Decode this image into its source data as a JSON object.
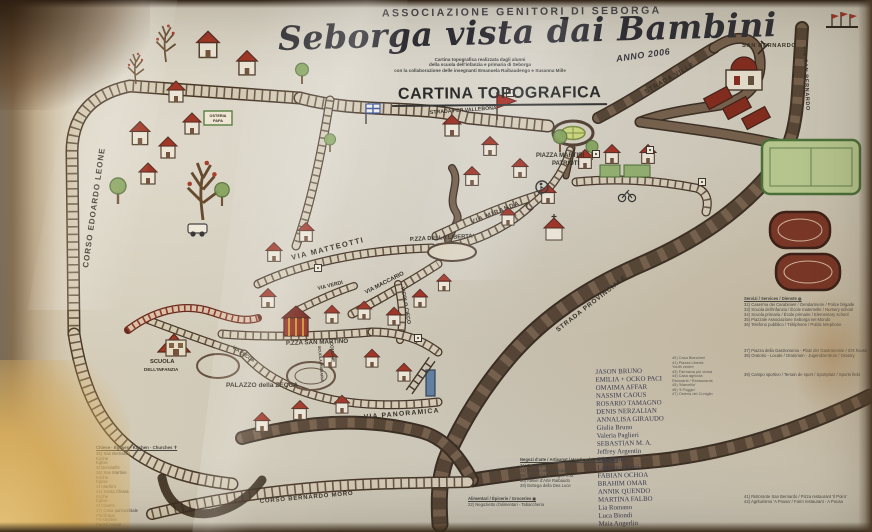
{
  "header": {
    "association": "ASSOCIAZIONE GENITORI DI SEBORGA",
    "title": "Seborga vista dai Bambini",
    "year": "ANNO 2006",
    "credits": [
      "Cartina topografica realizzata dagli alunni",
      "della scuola dell'infanzia e primaria di Seborga",
      "con la collaborazione delle insegnanti Emanuela Raibaudengo e Susanna Mille"
    ],
    "map_type": "CARTINA TOPOGRAFICA"
  },
  "streets": {
    "corso_edoardo_leone": "CORSO EDOARDO LEONE",
    "strada_per_vallebona": "STRADA PER VALLEBONA",
    "strada_ville": "STRADA VILLE",
    "via_san_bernardo": "VIA SAN BERNARDO",
    "strada_provinciale": "STRADA PROVINCIALE",
    "via_matteotti": "VIA MATTEOTTI",
    "via_verdi": "VIA VERDI",
    "via_maccario": "VIA MACCARIO",
    "vicolo_cieco": "VICOLO CIECO",
    "via_miranda": "VIA MIRANDA",
    "via_zecca": "VIA ZECCA",
    "via_panoramica": "VIA PANORAMICA",
    "corso_bernardo_moro": "CORSO BERNARDO MORO"
  },
  "places": {
    "san_bernardo": "SAN BERNARDO",
    "piazza_martiri_line1": "PIAZZA MARTIRI",
    "piazza_martiri_line2": "PATRIOTI",
    "piazza_liberta": "P.ZZA DELLA LIBERTA'",
    "piazza_san_martino": "P.ZZA SAN MARTINO",
    "palazzo_zecca": "PALAZZO della ZECCA",
    "scuola_line1": "SCUOLA",
    "scuola_line2": "DELL'INFANZIA",
    "scuola_primaria": "SCUOLA PRIMARIA",
    "comune": "COMUNE",
    "osteria_line1": "OSTERIA",
    "osteria_line2": "PAPA"
  },
  "legend_churches": {
    "title": "Chiese · Églises · Kirchen · Churches ✝",
    "lines": [
      "25) San Bernardo",
      "Kirche",
      "Église",
      "St Bernard's",
      "26) San Martino",
      "Kirche",
      "Église",
      "St Martin's",
      "24) Santa Chiara",
      "Kirche",
      "Église",
      "St Clare's",
      "27) Casa parrocchiale",
      "Pfarrhaus",
      "Presbytère",
      "Parish house"
    ]
  },
  "legend_crafts": {
    "title": "Negozi d'arte / Artisanat / Handwerk / Handicrafts",
    "lines": [
      "31) Formagetta",
      "23) Tessuto della Bandiera",
      "29) Atelier d'Arte 'Angeli R.M.'",
      "30) Atelier d'Arte Raibaudo",
      "28) Bottega della Dea Luce"
    ]
  },
  "legend_food": {
    "title": "Alimentari / Épicerie / Groceries ◼",
    "lines": [
      "22) Negozietto d'alimentari - Tabaccheria"
    ]
  },
  "legend_services": {
    "title": "Servizi / Services / Dienste ◍",
    "lines": [
      "32) Caserma dei Carabinieri / Gendarmerie / Police brigade",
      "33) Scuola dell'infanzia / École maternelle / Nursery school",
      "34) Scuola primaria / École primaire / Elementary school",
      "35) Piazzale Associazione Seborga nel Mondo",
      "36) Telefono pubblico / Téléphone / Public telephone"
    ]
  },
  "legend_community": {
    "lines": [
      "37) Piazza della Gastronomia - Platz der Gastronomie / St's house",
      "38) Oratorio - Locale / Oratorium - Jugendzentrum / Oratory"
    ]
  },
  "legend_sport": {
    "lines": [
      "39) Campo sportivo / Terrain de sport / Sportplatz / Sports field"
    ]
  },
  "legend_restaurants": {
    "lines": [
      "41) Ristorante San Bernardo / Pizza restaurant 'Il Poiro'",
      "42) Agriturismo 'A Pousa' / Farm restaurant - A Pousa"
    ]
  },
  "legend_right_mid": {
    "lines": [
      "40) Casa Biancheri",
      "41) Piazza Libertà",
      "Youth centre",
      "43) Farmacia più vicina",
      "44) Casa agricola",
      "Ristoranti / Restaurants",
      "45) 'Marcellin'",
      "46) 'Il Poggio'",
      "47) Osteria del Coniglio"
    ]
  },
  "signatures": [
    "JASON BRUNO",
    "EMILIA + OCKO PACI",
    "OMAIMA AFFAR",
    "NASSIM CAOUS",
    "ROSARIO TAMAGNO",
    "DENIS NERZALIAN",
    "ANNALISA GIRAUDO",
    "Giulia Bruno",
    "Valeria Paglieri",
    "SEBASTIAN M. A.",
    "Jeffrey Argentin",
    "Elba Pardo",
    "Ludovica Ricci",
    "FABIAN OCHOA",
    "BRAHIM OMAR",
    "ANNIK QUENDO",
    "MARTINA FALBO",
    "Lia Romano",
    "Luca Biondi",
    "Maia Angerlin"
  ],
  "colors": {
    "paper": "#d7d0c0",
    "road_brown": "#6f5843",
    "road_dark": "#2f2217",
    "roof_red": "#942618",
    "stain_amber": "#d9b367",
    "leaf_green": "#7da054",
    "court_red": "#73291a",
    "field_green": "#b9cc8e",
    "ink": "#2b231a",
    "flag_blue": "#33519e"
  }
}
